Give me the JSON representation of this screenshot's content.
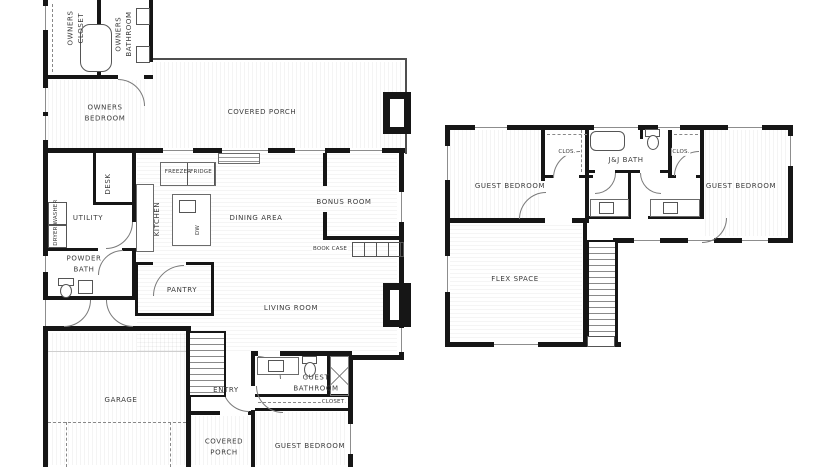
{
  "title": "Two-story residence floor plan",
  "colors": {
    "wall": "#161616",
    "line": "#555555",
    "label": "#3b3b3b",
    "background": "#ffffff"
  },
  "first_floor": {
    "owners_closet": "OWNERS\nCLOSET",
    "owners_bathroom": "OWNERS\nBATHROOM",
    "owners_bedroom": "OWNERS\nBEDROOM",
    "covered_porch": "COVERED PORCH",
    "desk": "DESK",
    "utility": "UTILITY",
    "washer": "WASHER",
    "dryer": "DRYER",
    "powder_bath": "POWDER\nBATH",
    "kitchen": "KITCHEN",
    "freezer": "FREEZER",
    "fridge": "FRIDGE",
    "dw": "DW",
    "dining_area": "DINING AREA",
    "bonus_room": "BONUS ROOM",
    "book_case": "BOOK CASE",
    "pantry": "PANTRY",
    "living_room": "LIVING ROOM",
    "garage": "GARAGE",
    "entry": "ENTRY",
    "covered_porch_lower": "COVERED\nPORCH",
    "guest_bathroom": "GUEST\nBATHROOM",
    "closet": "CLOSET",
    "guest_bedroom": "GUEST BEDROOM"
  },
  "second_floor": {
    "guest_bedroom_left": "GUEST BEDROOM",
    "closet_left": "CLOS.",
    "jj_bath": "J&J BATH",
    "closet_right": "CLOS.",
    "guest_bedroom_right": "GUEST BEDROOM",
    "flex_space": "FLEX SPACE"
  }
}
